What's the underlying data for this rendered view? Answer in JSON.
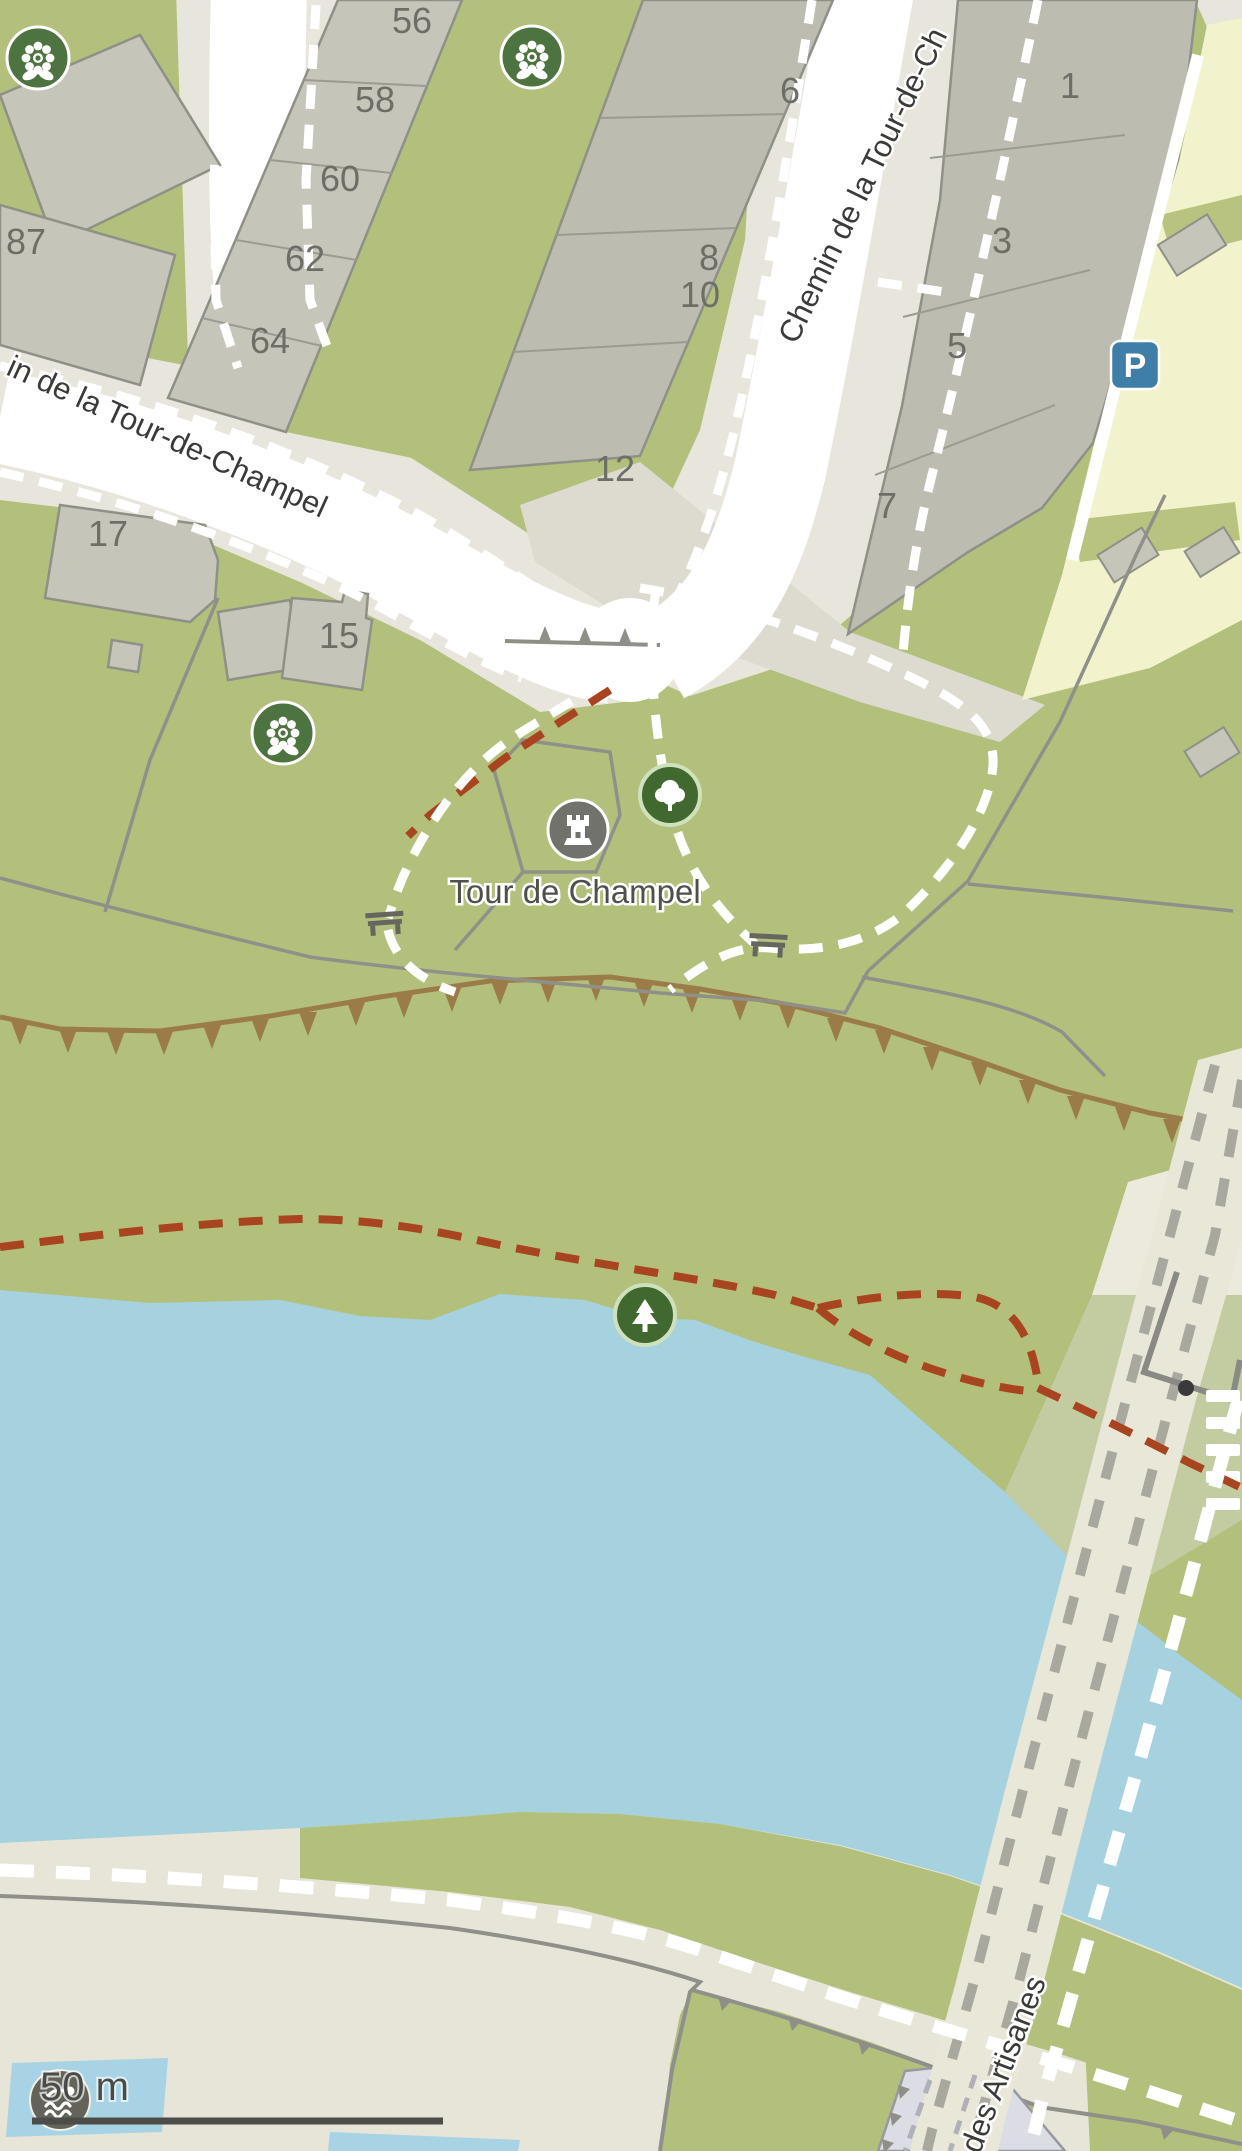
{
  "map_labels": {
    "poi_tour": "Tour de Champel",
    "street_chemin_top": "Chemin de la Tour-de-Ch",
    "street_chemin_left": "in de la Tour-de-Champel",
    "street_artisanes": "des Artisanes",
    "scale": "50 m",
    "parking_letter": "P"
  },
  "house_numbers": {
    "n56": "56",
    "n58": "58",
    "n60": "60",
    "n62": "62",
    "n64": "64",
    "n87": "87",
    "n17": "17",
    "n15": "15",
    "n12": "12",
    "n6": "6",
    "n8": "8",
    "n10": "10",
    "n1": "1",
    "n3": "3",
    "n5": "5",
    "n7": "7"
  },
  "icons": {
    "flower": "park-flower-icon",
    "deciduous_tree": "deciduous-tree-icon",
    "conifer_tree": "conifer-tree-icon",
    "tower": "castle-tower-icon",
    "parking": "parking-icon",
    "bench": "bench-icon",
    "swimmer": "swimming-icon"
  },
  "colors": {
    "grass_green": "#b2c07c",
    "water_blue": "#a5d2de",
    "road_white": "#ffffff",
    "paved_beige": "#e8e6dc",
    "sidewalk": "#dddbd0",
    "building_gray": "#c6c5b9",
    "building_dark": "#bdbcb0",
    "building_outline": "#8f9087",
    "parking_lot": "#f2f3cd",
    "parking_sign_blue": "#3e7ea7",
    "poi_circle_green": "#4d7340",
    "trail_red": "#a8441f",
    "cliff_brown": "#9b7c49",
    "esplanade": "#e7e5d8",
    "pool_blue": "#a8d3e4",
    "railway_band": "#e9e7d8",
    "railway_dash": "#a9a89e",
    "station_lavender": "#dcdce4",
    "icon_circle_gray": "#72726c",
    "swim_circle": "#63635a"
  }
}
